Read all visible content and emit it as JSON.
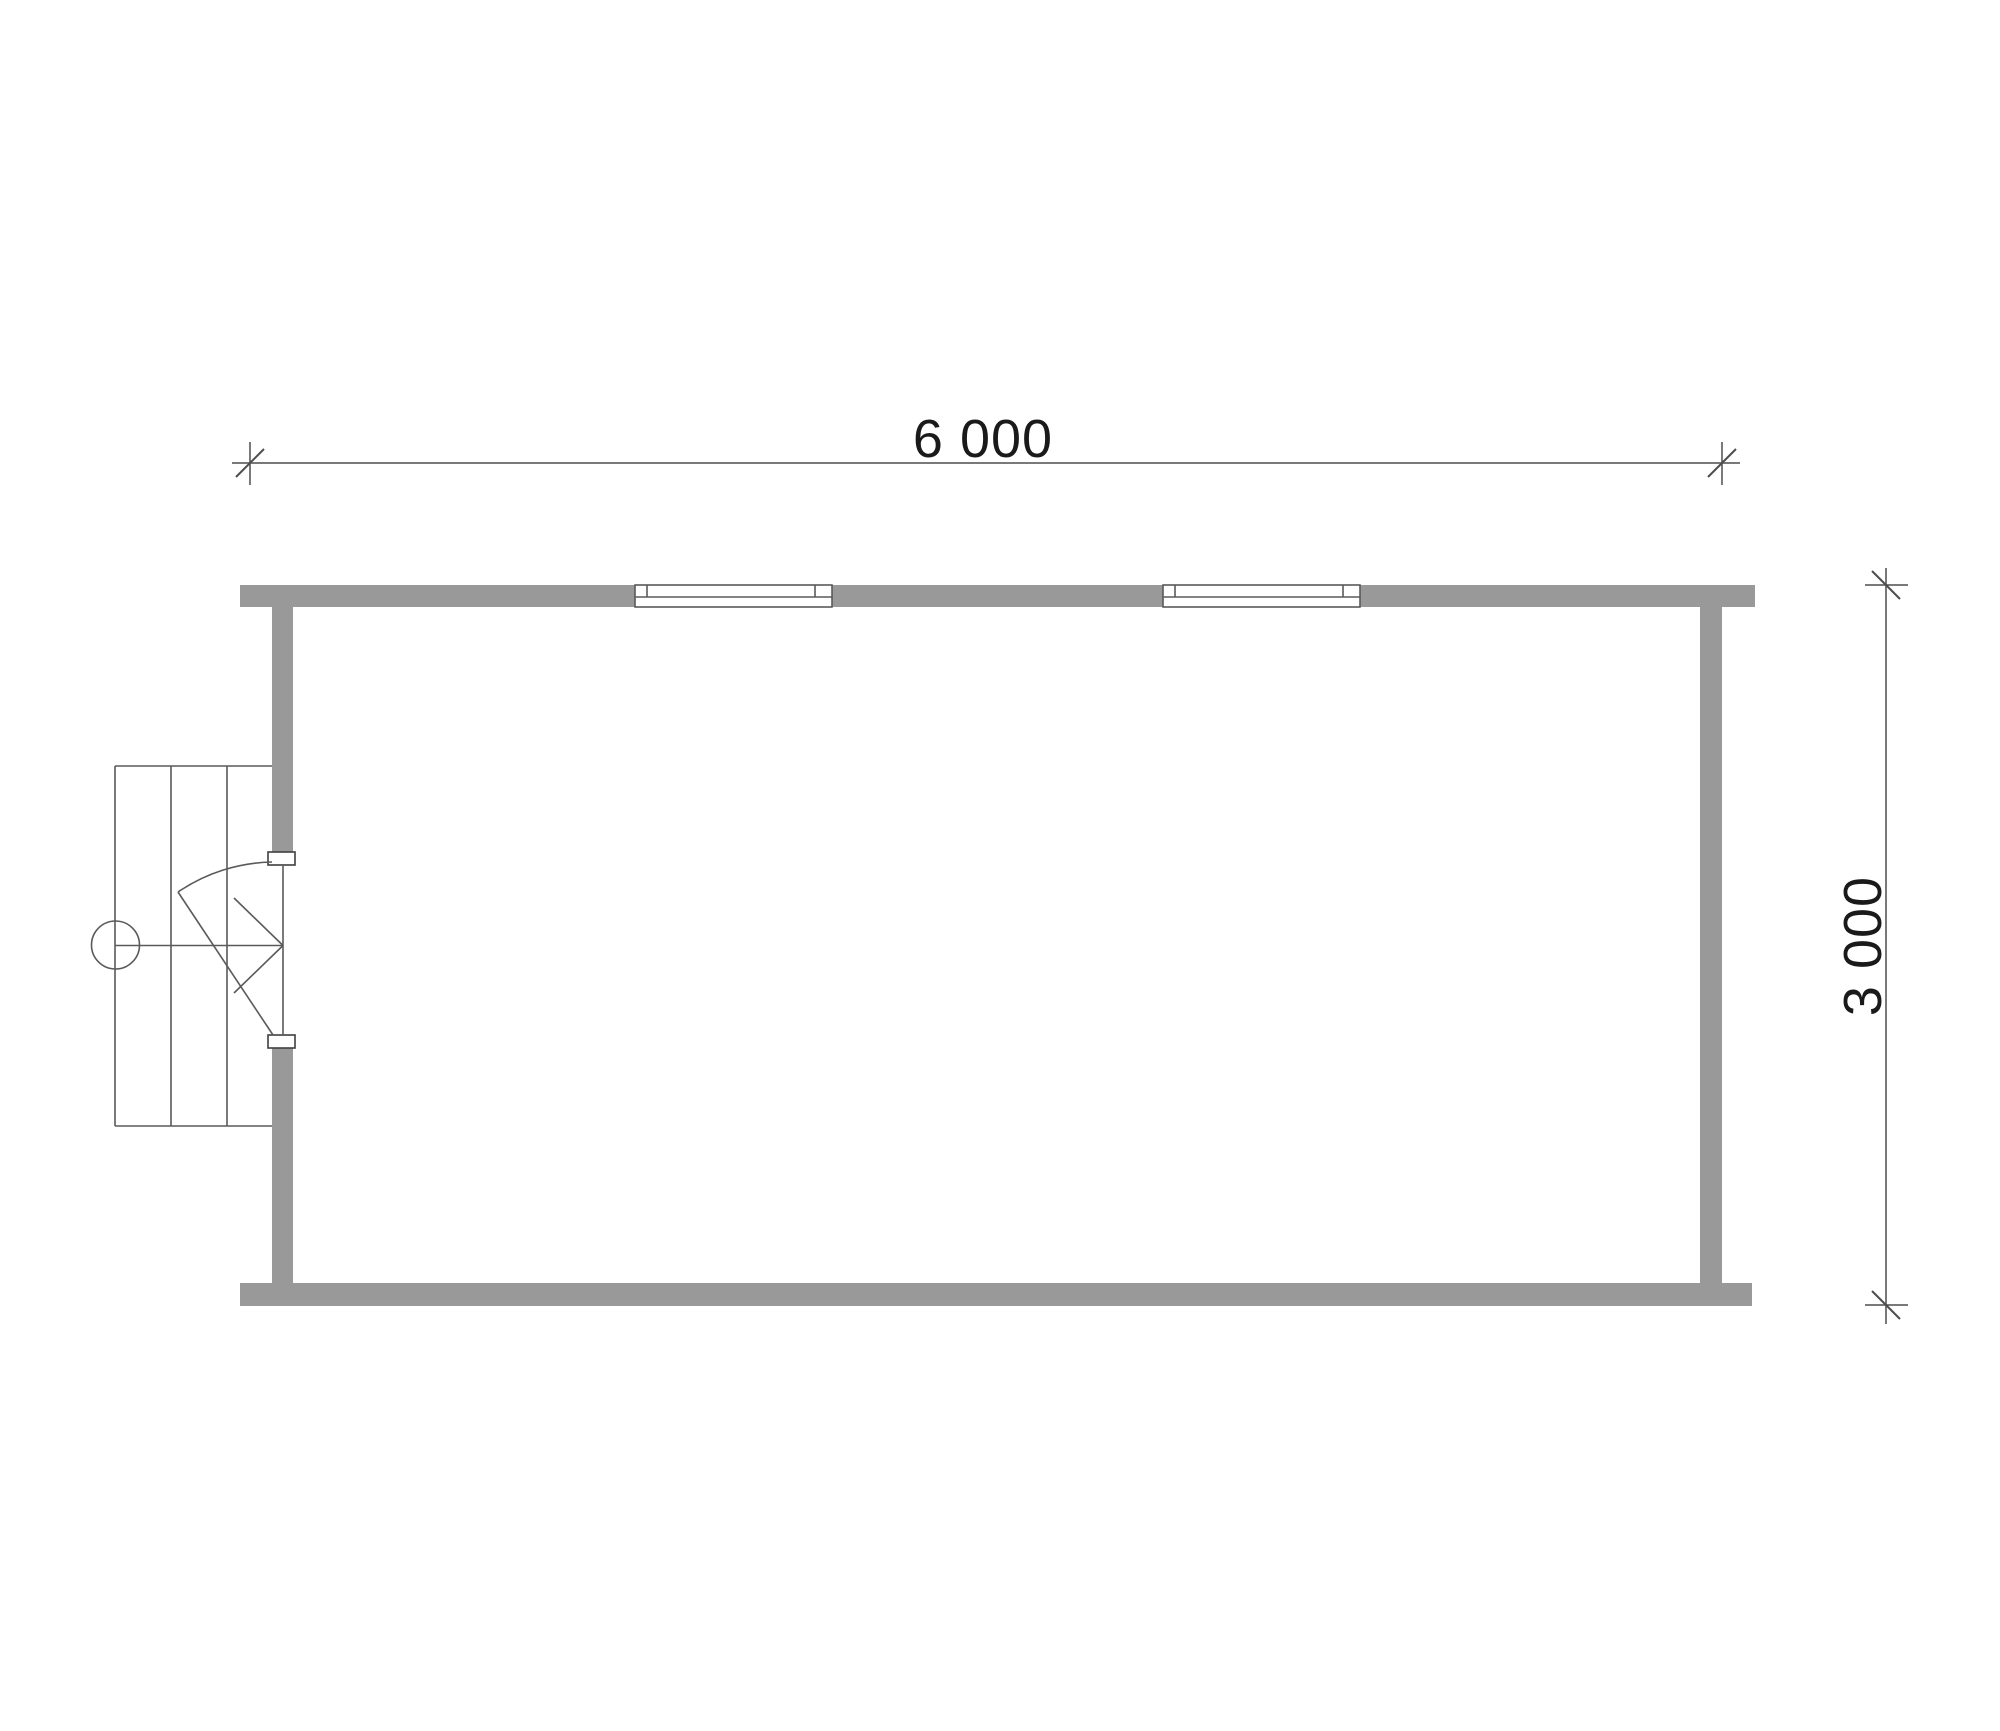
{
  "plan": {
    "dimensions": {
      "width_label": "6 000",
      "height_label": "3 000"
    }
  },
  "colors": {
    "background": "#ffffff",
    "wall_fill": "#999999",
    "opening_fill": "#ffffff",
    "detail_line": "#5a5a5a",
    "jamb_line": "#3f3f3f",
    "dimension_line": "#4d4d4d",
    "text": "#1a1a1a"
  }
}
